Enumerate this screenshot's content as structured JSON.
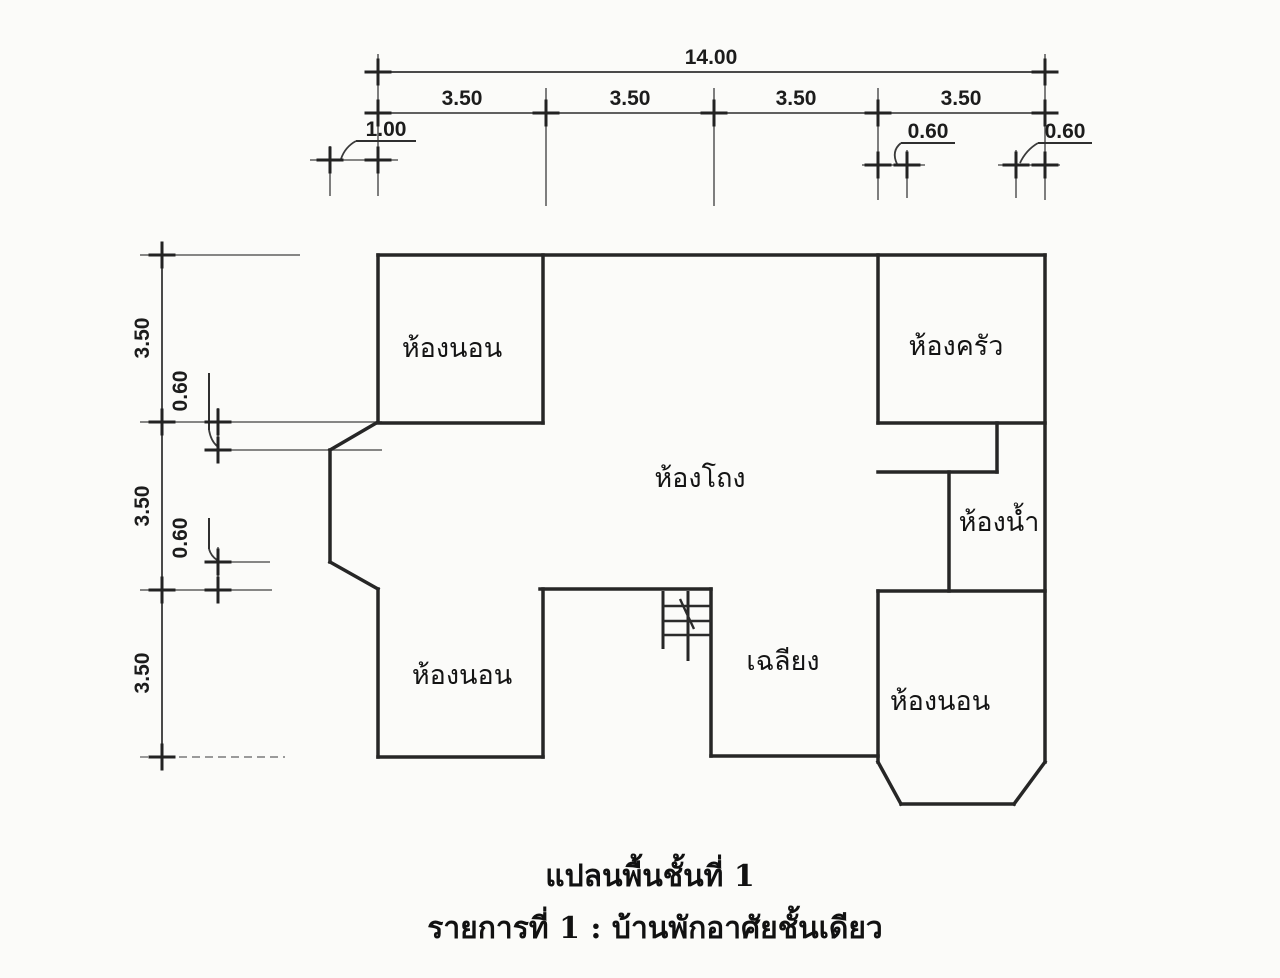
{
  "plan": {
    "captions": {
      "line1": "แปลนพื้นชั้นที่ 1",
      "line2": "รายการที่ 1 : บ้านพักอาศัยชั้นเดียว"
    },
    "rooms": {
      "bedroom_top_left": "ห้องนอน",
      "kitchen": "ห้องครัว",
      "hall": "ห้องโถง",
      "bathroom": "ห้องน้ำ",
      "bedroom_bottom_left": "ห้องนอน",
      "porch": "เฉลียง",
      "bedroom_bottom_right": "ห้องนอน"
    },
    "dims": {
      "top_total": "14.00",
      "top_spans": [
        "3.50",
        "3.50",
        "3.50",
        "3.50"
      ],
      "top_offset_left": "1.00",
      "top_offset_mid": "0.60",
      "top_offset_right": "0.60",
      "left_spans": [
        "3.50",
        "3.50",
        "3.50"
      ],
      "left_offset_upper": "0.60",
      "left_offset_lower": "0.60"
    },
    "colors": {
      "wall": "#262626",
      "dimension_line": "#4a4a4a",
      "text": "#161616",
      "background": "#fbfbf9"
    }
  }
}
